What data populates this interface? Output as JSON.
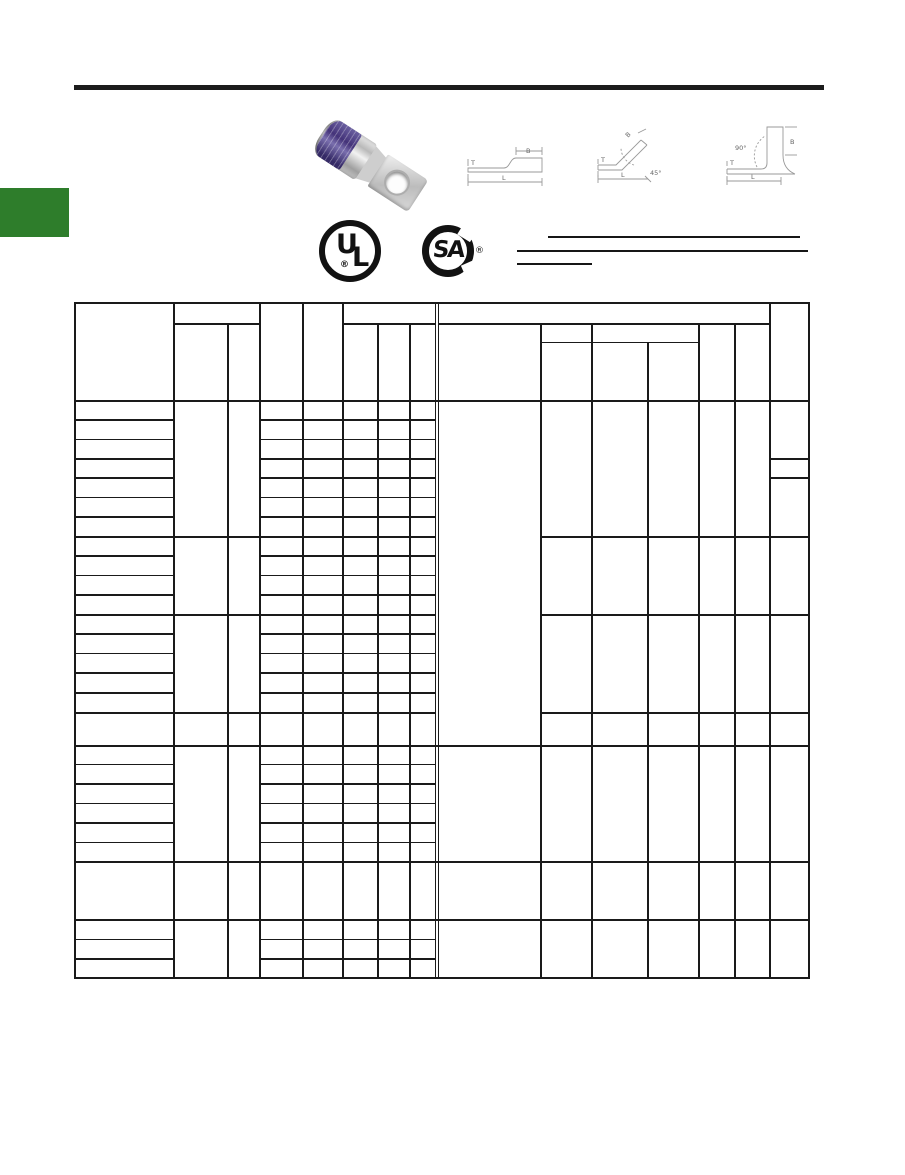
{
  "page": {
    "kind": "catalog-datasheet-page",
    "background": "#ffffff"
  },
  "colors": {
    "top_rule": "#1c1c1c",
    "green_tab": "#2e7d2b",
    "table_lines": "#1a1a1a",
    "lug_band_purple": "#443379",
    "lug_metal": "#c4c4c4",
    "diagram_lines": "#999999"
  },
  "logos": {
    "ul": {
      "letter_u": "U",
      "letter_l": "L",
      "registered": "®"
    },
    "csa": {
      "letters": "SA",
      "registered": "®"
    }
  },
  "diagrams": {
    "straight": {
      "b": "B",
      "t": "T",
      "l": "L"
    },
    "deg45": {
      "b": "B",
      "t": "T",
      "l": "L",
      "angle": "45°"
    },
    "deg90": {
      "b": "B",
      "t": "T",
      "l": "L",
      "angle": "90°"
    }
  },
  "table": {
    "note": "",
    "cells_text": []
  }
}
